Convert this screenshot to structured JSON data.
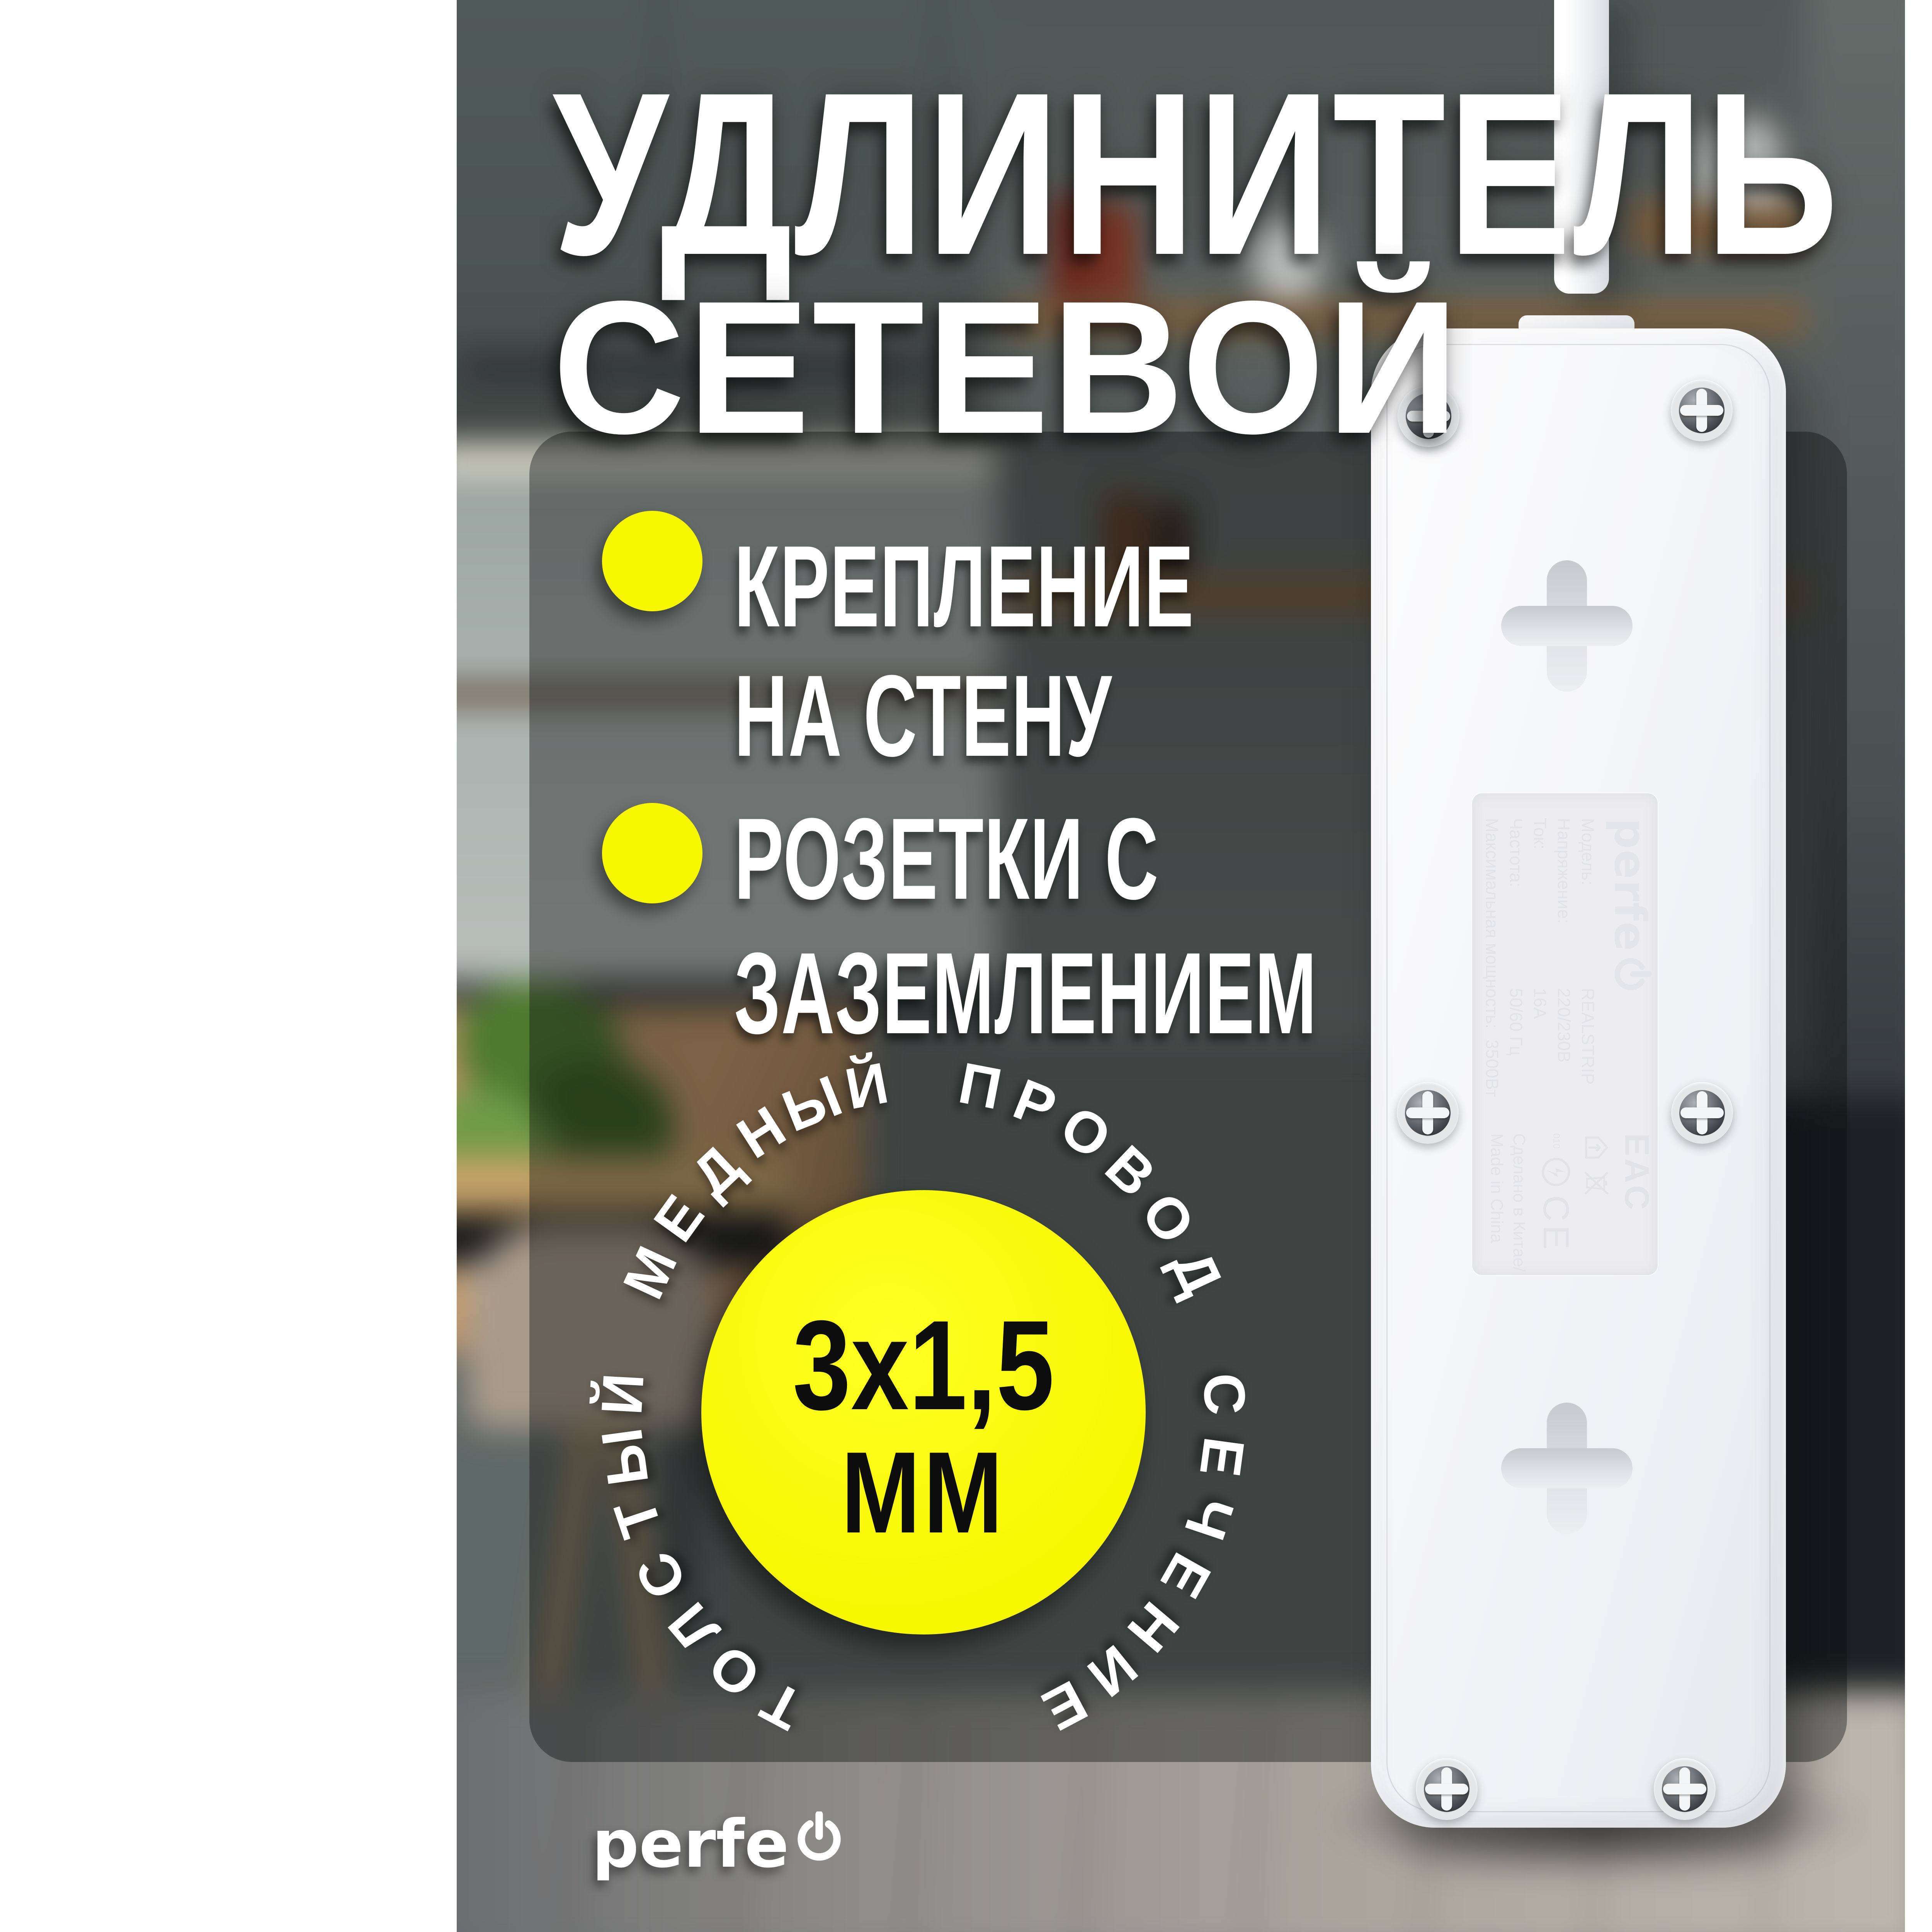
{
  "title": {
    "line1": "УДЛИНИТЕЛЬ",
    "line2": "СЕТЕВОЙ"
  },
  "features": [
    {
      "line1": "КРЕПЛЕНИЕ",
      "line2": "НА СТЕНУ"
    },
    {
      "line1": "РОЗЕТКИ С",
      "line2": "ЗАЗЕМЛЕНИЕМ"
    }
  ],
  "badge": {
    "ring_text": "ТОЛСТЫЙ МЕДНЫЙ ПРОВОД СЕЧЕНИЕ",
    "value": "3x1,5",
    "unit": "ММ"
  },
  "brand": {
    "wordmark": "perfe",
    "icon": "power-icon"
  },
  "device_label": {
    "brand_wordmark": "perfe",
    "rows": [
      {
        "name": "Модель:",
        "value": "REALSTRIP"
      },
      {
        "name": "Напряжение:",
        "value": "220/230В"
      },
      {
        "name": "Ток:",
        "value": "16А"
      },
      {
        "name": "Частота:",
        "value": "50/60 Гц"
      },
      {
        "name": "Максимальная мощность:",
        "value": "3500Вт"
      }
    ],
    "made_in_line1": "Сделано в Китае/",
    "made_in_line2": "Made in China",
    "marks": {
      "eac": "EAC",
      "ce": "CE",
      "rst": "010"
    }
  },
  "colors": {
    "accent_yellow": "#f7f700",
    "panel_overlay": "rgba(12,15,16,0.40)",
    "title_white": "#ffffff",
    "badge_text": "#0d0d0d"
  }
}
